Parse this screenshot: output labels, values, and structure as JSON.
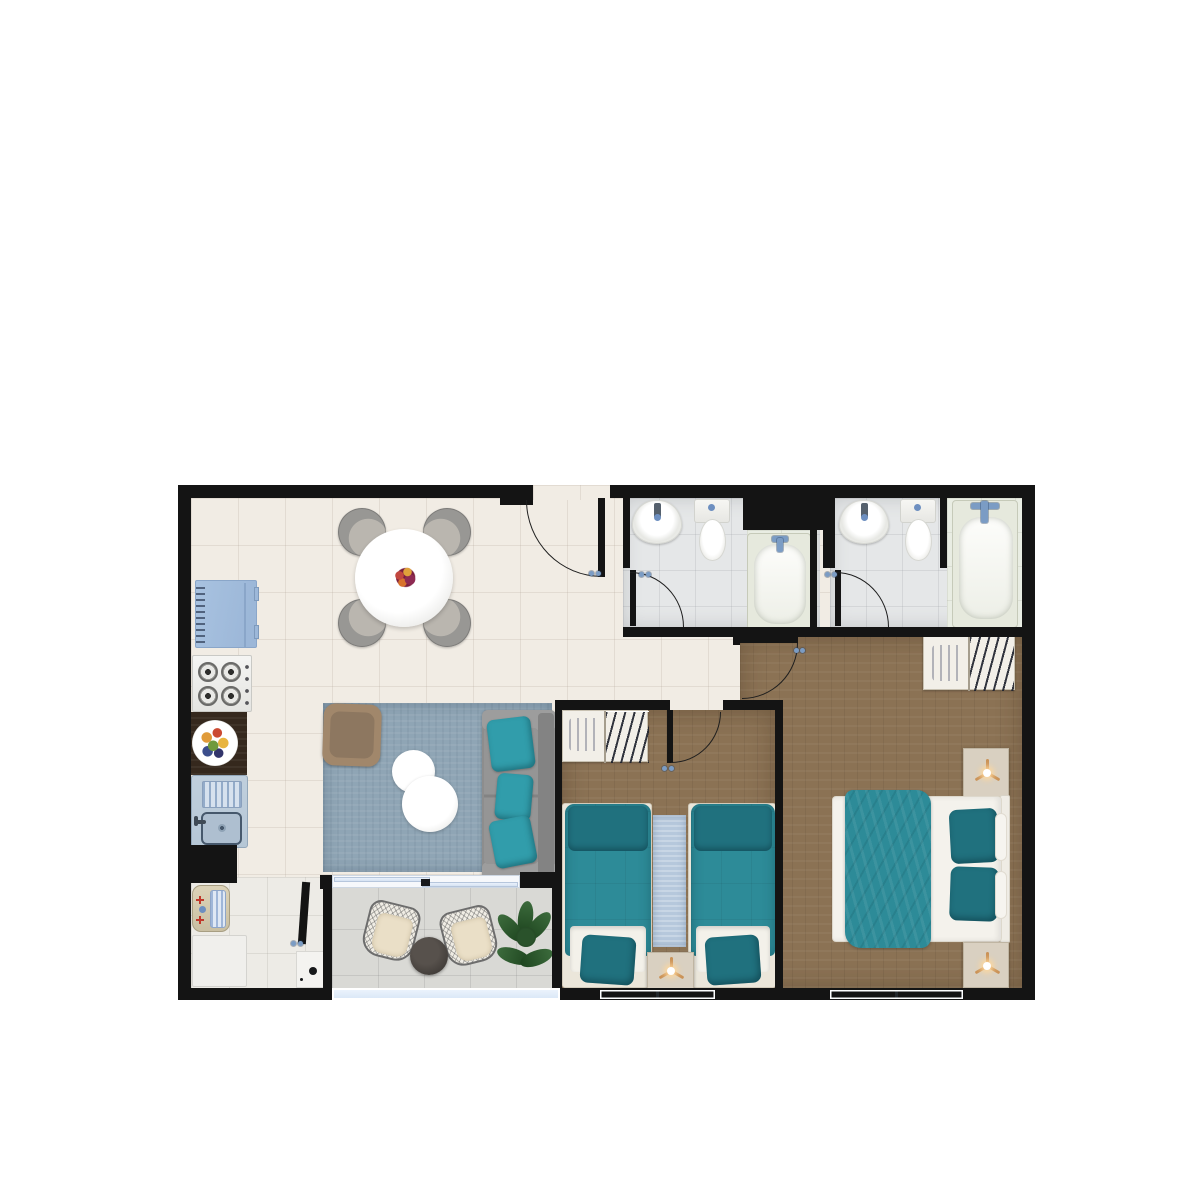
{
  "image_type": "rendered-apartment-floor-plan-top-view",
  "palette": {
    "wall": "#141414",
    "arc": "#1e1e1e",
    "floor_main": "#f1ece4",
    "floor_bath": "#e5e7e8",
    "floor_tub": "#e9ede3",
    "floor_wood": "#8b7254",
    "floor_balcony": "#d9d9d5",
    "floor_laundry": "#edebe6",
    "rug_living": "#8fa5b5",
    "rug_runner": "#b6c8dc",
    "teal": "#2d8b98",
    "teal_dark": "#20717e",
    "teal_bright": "#319dab",
    "sofa": "#8d8d8d",
    "sofa_light": "#9d9d9d",
    "chair_gray": "#989794",
    "chair_seat": "#bab6af",
    "fridge": "#a8c2e0",
    "sink_unit": "#b6c7d6",
    "counter": "#35281d",
    "closet_blue": "#7590bb",
    "nightstand": "#d9d0c1",
    "lamp": "#ca9257",
    "armchair": "#a1876b",
    "glass": "#dfe9f6",
    "faucet": "#7b9cc4",
    "cushion": "#eadfc7",
    "balcony_table": "#45403c"
  },
  "rooms": [
    {
      "name": "kitchen",
      "floor": "cream-tile",
      "furniture": [
        "refrigerator",
        "gas-stove-4-burners",
        "dark-wood-counter",
        "fruit-plate",
        "kitchen-sink-with-drainboard"
      ]
    },
    {
      "name": "dining-area",
      "floor": "cream-tile",
      "furniture": [
        "round-dining-table",
        "flower-centerpiece",
        "dining-chair-top-left",
        "dining-chair-top-right",
        "dining-chair-bottom-left",
        "dining-chair-bottom-right"
      ]
    },
    {
      "name": "living-area",
      "floor": "cream-tile",
      "furniture": [
        "blue-gray-area-rug",
        "tan-armchair",
        "round-coffee-table-small",
        "round-coffee-table-large",
        "gray-sofa",
        "teal-throw-pillows-x3"
      ]
    },
    {
      "name": "hallway",
      "floor": "cream-tile",
      "furniture": []
    },
    {
      "name": "bathroom-1",
      "floor": "gray-tile",
      "furniture": [
        "washbasin",
        "toilet",
        "bathtub"
      ]
    },
    {
      "name": "bathroom-2",
      "floor": "gray-tile",
      "furniture": [
        "washbasin",
        "toilet",
        "bathtub"
      ]
    },
    {
      "name": "bedroom-1",
      "floor": "wood",
      "furniture": [
        "closet-shelf-and-hangers",
        "twin-bed-left",
        "twin-bed-right",
        "blue-runner-rug",
        "nightstand-with-lamp"
      ]
    },
    {
      "name": "bedroom-2",
      "floor": "wood",
      "furniture": [
        "closet-shelf-and-hangers",
        "double-bed-teal-blanket",
        "nightstand-with-lamp-upper",
        "nightstand-with-lamp-lower"
      ]
    },
    {
      "name": "laundry-nook",
      "floor": "white-tile",
      "furniture": [
        "laundry-sink-with-washboard",
        "washing-machine",
        "small-appliance"
      ]
    },
    {
      "name": "balcony",
      "floor": "gray-tile",
      "furniture": [
        "wicker-chair-left",
        "wicker-chair-right",
        "round-side-table",
        "potted-plant"
      ]
    }
  ],
  "openings": [
    "entry-door-top-wall",
    "bathroom-1-door",
    "bathroom-2-door",
    "bedroom-1-door",
    "bedroom-2-door",
    "laundry-door",
    "balcony-sliding-door",
    "balcony-glass-railing",
    "bedroom-1-window",
    "bedroom-2-window"
  ]
}
